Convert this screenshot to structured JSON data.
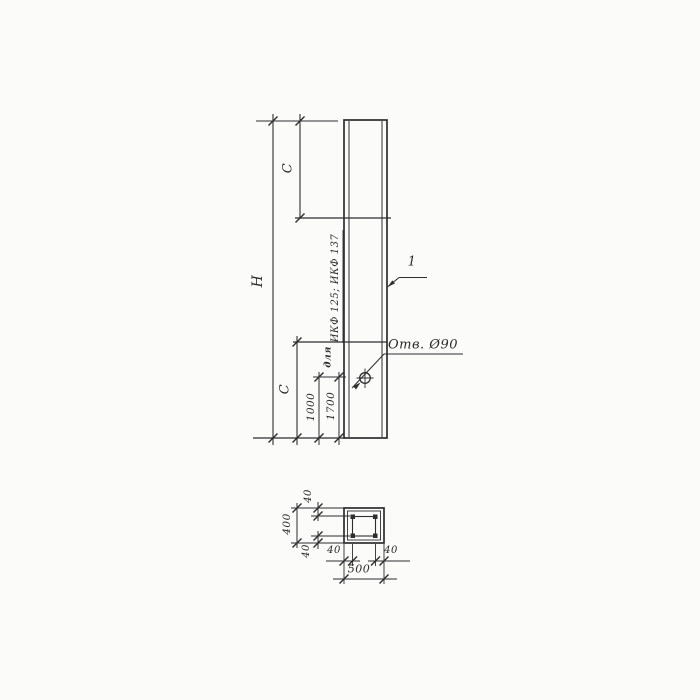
{
  "drawing_type": "technical-drawing-precast-column",
  "elevation": {
    "height_dim": "H",
    "top_zone_dim": "C",
    "bottom_zone_dim": "C",
    "hole_offset_dim_1": "1000",
    "hole_offset_dim_2": "1700",
    "hole_note_prefix": "для",
    "hole_note_types": "ИКФ 125; ИКФ 137",
    "hole_label": "Отв. Ø90",
    "part_number": "1"
  },
  "section": {
    "width_dim": "500",
    "height_dim": "400",
    "cover_top_dim": "40",
    "cover_bottom_dim": "40",
    "cover_left_dim": "40",
    "cover_right_dim": "40"
  },
  "colors": {
    "paper": "#fbfbf9",
    "line": "#2e2e2e"
  }
}
